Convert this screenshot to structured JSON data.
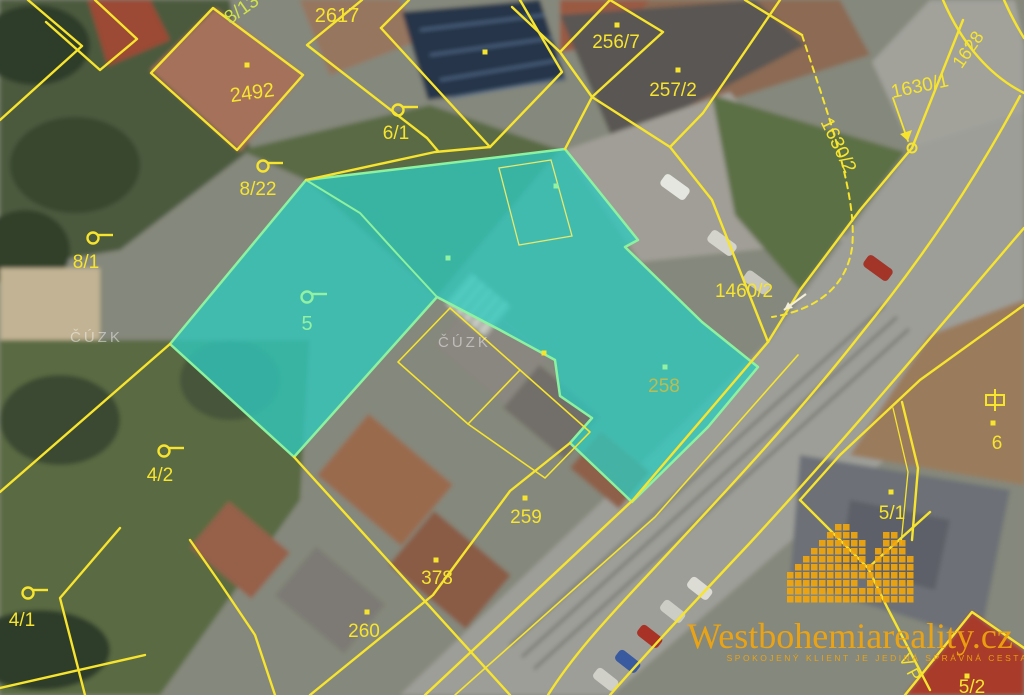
{
  "map": {
    "type": "cadastral-aerial-map",
    "width": 1024,
    "height": 695,
    "colors": {
      "parcel_line": "#f6e42e",
      "highlight_fill": "#2fc9be",
      "highlight_border": "#8df2a0",
      "label_yellow": "#f6e42e",
      "label_green": "#90f2a2",
      "label_olive": "#b9bd52",
      "label_yellow_green": "#cfe24c",
      "arrow_white": "#f2eed8",
      "watermark_white": "rgba(255,255,255,0.45)",
      "brand_gold": "#f2a60d"
    },
    "parcel_labels": [
      {
        "text": "8/13",
        "x": 245,
        "y": 14,
        "rot": -35,
        "size": 19,
        "color": "label_yellow_green"
      },
      {
        "text": "2617",
        "x": 337,
        "y": 22,
        "rot": 0,
        "size": 20,
        "color": "label_yellow"
      },
      {
        "text": "2492",
        "x": 253,
        "y": 99,
        "rot": -8,
        "size": 20,
        "color": "label_yellow"
      },
      {
        "text": "6/1",
        "x": 396,
        "y": 139,
        "rot": 0,
        "size": 19,
        "color": "label_yellow"
      },
      {
        "text": "8/22",
        "x": 258,
        "y": 195,
        "rot": 0,
        "size": 19,
        "color": "label_yellow"
      },
      {
        "text": "8/1",
        "x": 86,
        "y": 268,
        "rot": 0,
        "size": 19,
        "color": "label_yellow"
      },
      {
        "text": "5",
        "x": 307,
        "y": 330,
        "rot": 0,
        "size": 20,
        "color": "label_green"
      },
      {
        "text": "256/7",
        "x": 616,
        "y": 48,
        "rot": 0,
        "size": 19,
        "color": "label_yellow"
      },
      {
        "text": "257/2",
        "x": 673,
        "y": 96,
        "rot": 0,
        "size": 19,
        "color": "label_yellow"
      },
      {
        "text": "1630/1",
        "x": 921,
        "y": 92,
        "rot": -12,
        "size": 19,
        "color": "label_yellow"
      },
      {
        "text": "1630/2",
        "x": 833,
        "y": 148,
        "rot": 64,
        "size": 19,
        "color": "label_yellow"
      },
      {
        "text": "1628",
        "x": 973,
        "y": 53,
        "rot": -55,
        "size": 18,
        "color": "label_yellow"
      },
      {
        "text": "1460/2",
        "x": 744,
        "y": 297,
        "rot": 0,
        "size": 19,
        "color": "label_yellow"
      },
      {
        "text": "258",
        "x": 664,
        "y": 392,
        "rot": 0,
        "size": 19,
        "color": "label_olive"
      },
      {
        "text": "259",
        "x": 526,
        "y": 523,
        "rot": 0,
        "size": 19,
        "color": "label_yellow"
      },
      {
        "text": "378",
        "x": 437,
        "y": 584,
        "rot": 0,
        "size": 19,
        "color": "label_yellow"
      },
      {
        "text": "260",
        "x": 364,
        "y": 637,
        "rot": 0,
        "size": 19,
        "color": "label_yellow"
      },
      {
        "text": "4/2",
        "x": 160,
        "y": 481,
        "rot": 0,
        "size": 19,
        "color": "label_yellow"
      },
      {
        "text": "4/1",
        "x": 22,
        "y": 626,
        "rot": 0,
        "size": 19,
        "color": "label_yellow"
      },
      {
        "text": "6",
        "x": 997,
        "y": 449,
        "rot": 0,
        "size": 19,
        "color": "label_yellow"
      },
      {
        "text": "5/1",
        "x": 892,
        "y": 519,
        "rot": 0,
        "size": 19,
        "color": "label_yellow"
      },
      {
        "text": "5/2",
        "x": 972,
        "y": 693,
        "rot": 0,
        "size": 19,
        "color": "label_yellow"
      },
      {
        "text": "V P",
        "x": 905,
        "y": 670,
        "rot": 62,
        "size": 17,
        "color": "label_yellow"
      }
    ],
    "symbols": [
      {
        "type": "garden",
        "x": 398,
        "y": 110,
        "color": "label_yellow"
      },
      {
        "type": "garden",
        "x": 263,
        "y": 166,
        "color": "label_yellow"
      },
      {
        "type": "garden",
        "x": 93,
        "y": 238,
        "color": "label_yellow"
      },
      {
        "type": "garden",
        "x": 164,
        "y": 451,
        "color": "label_yellow"
      },
      {
        "type": "garden",
        "x": 28,
        "y": 593,
        "color": "label_yellow"
      },
      {
        "type": "garden",
        "x": 307,
        "y": 297,
        "color": "label_green"
      },
      {
        "type": "building",
        "x": 995,
        "y": 400,
        "color": "label_yellow"
      },
      {
        "type": "junction",
        "x": 912,
        "y": 148,
        "color": "label_yellow"
      },
      {
        "type": "dot",
        "x": 247,
        "y": 65,
        "color": "label_yellow"
      },
      {
        "type": "dot",
        "x": 617,
        "y": 25,
        "color": "label_yellow"
      },
      {
        "type": "dot",
        "x": 678,
        "y": 70,
        "color": "label_yellow"
      },
      {
        "type": "dot",
        "x": 485,
        "y": 52,
        "color": "label_yellow"
      },
      {
        "type": "dot",
        "x": 525,
        "y": 498,
        "color": "label_yellow"
      },
      {
        "type": "dot",
        "x": 436,
        "y": 560,
        "color": "label_yellow"
      },
      {
        "type": "dot",
        "x": 367,
        "y": 612,
        "color": "label_yellow"
      },
      {
        "type": "dot",
        "x": 891,
        "y": 492,
        "color": "label_yellow"
      },
      {
        "type": "dot",
        "x": 993,
        "y": 423,
        "color": "label_yellow"
      },
      {
        "type": "dot",
        "x": 967,
        "y": 676,
        "color": "label_yellow"
      },
      {
        "type": "dot",
        "x": 544,
        "y": 353,
        "color": "label_yellow"
      },
      {
        "type": "dot",
        "x": 448,
        "y": 258,
        "color": "label_green"
      },
      {
        "type": "dot",
        "x": 556,
        "y": 186,
        "color": "label_green"
      },
      {
        "type": "dot",
        "x": 665,
        "y": 367,
        "color": "label_green"
      },
      {
        "type": "arrow",
        "x": 806,
        "y": 294,
        "x2": 784,
        "y2": 310,
        "color": "arrow_white"
      }
    ],
    "agency_watermarks": [
      {
        "text": "ČÚZK",
        "x": 70,
        "y": 342
      },
      {
        "text": "ČÚZK",
        "x": 438,
        "y": 347
      }
    ],
    "brand": {
      "name": "Westbohemiareality.cz",
      "slogan": "SPOKOJENÝ KLIENT JE JEDINÁ SPRÁVNÁ CESTA!"
    }
  }
}
